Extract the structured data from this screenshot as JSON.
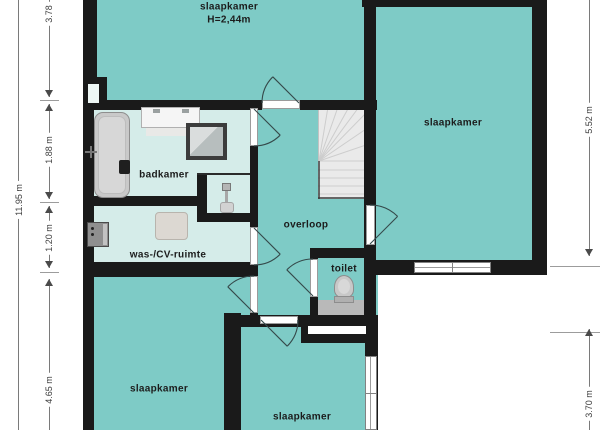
{
  "floorplan": {
    "rooms": {
      "bedroom_top": {
        "label": "slaapkamer",
        "height": "H=2,44m"
      },
      "bedroom_right": {
        "label": "slaapkamer"
      },
      "bedroom_bottom_left": {
        "label": "slaapkamer"
      },
      "bedroom_bottom_center": {
        "label": "slaapkamer"
      },
      "bathroom": {
        "label": "badkamer"
      },
      "utility": {
        "label": "was-/CV-ruimte"
      },
      "landing": {
        "label": "overloop"
      },
      "toilet": {
        "label": "toilet"
      }
    },
    "dimensions": {
      "left_total": "11.95 m",
      "left_segments": [
        "3.78",
        "1.88 m",
        "1.20 m",
        "4.65 m"
      ],
      "right_segments": [
        "5.52 m",
        "3.70 m"
      ]
    },
    "fixtures": [
      "staircase",
      "bathtub",
      "washbasin-counter",
      "shower",
      "hand-basin",
      "washing-machine",
      "cv-boiler",
      "toilet-bowl"
    ],
    "colors": {
      "floor": "#7ecbc6",
      "floor_light": "#d5ece9",
      "wall": "#1a1a1a",
      "stairs": "#eaeaea"
    }
  }
}
